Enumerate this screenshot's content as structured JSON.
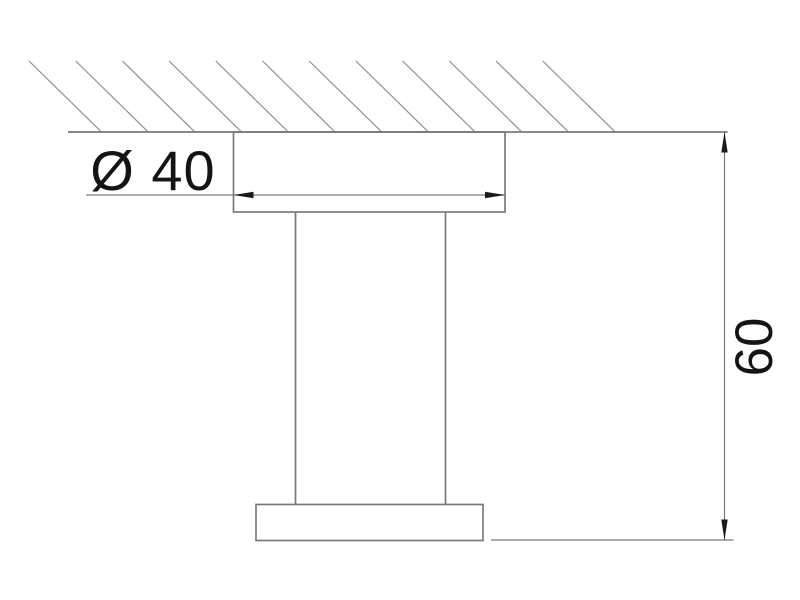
{
  "drawing": {
    "type": "technical-dimension-drawing",
    "labels": {
      "diameter": "Ø 40",
      "height": "60"
    },
    "colors": {
      "background": "#ffffff",
      "outline": "#7a7a7a",
      "hatch": "#8f8f8f",
      "dimension": "#7a7a7a",
      "arrow": "#1a1a1a",
      "text": "#141414"
    }
  }
}
